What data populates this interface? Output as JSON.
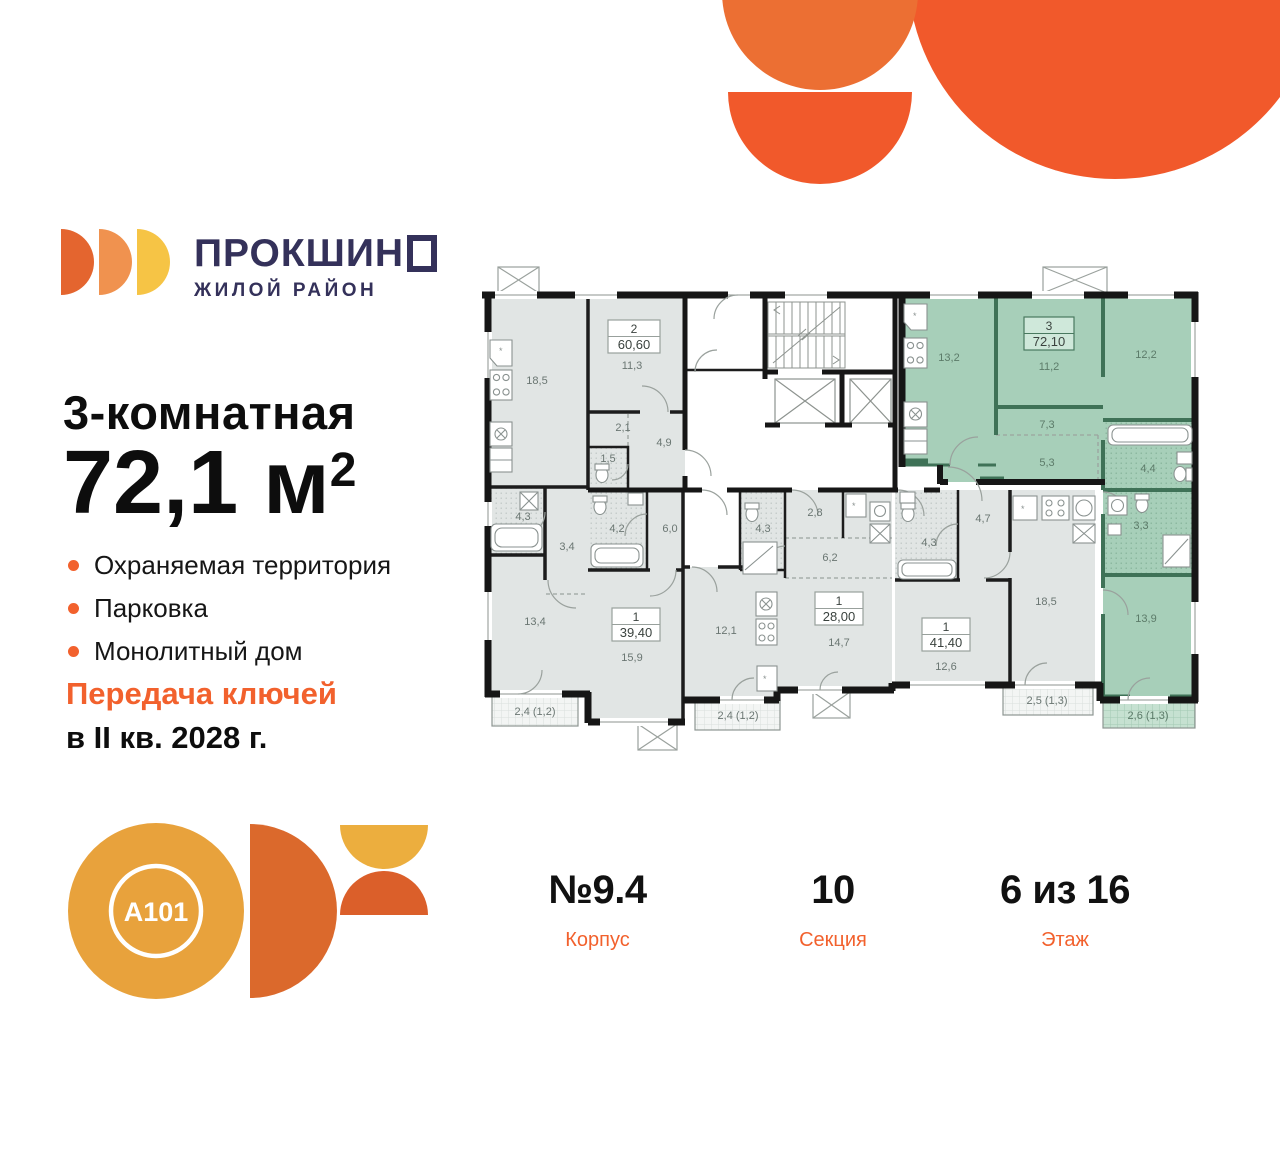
{
  "brand": {
    "name_prefix": "ПРОКШИН",
    "tagline": "ЖИЛОЙ РАЙОН"
  },
  "listing": {
    "headline": "3-комнатная",
    "area_value": "72,1",
    "area_unit": " м",
    "area_exponent": "2",
    "features": [
      "Охраняемая территория",
      "Парковка",
      "Монолитный дом"
    ],
    "handover_line1": "Передача ключей",
    "handover_line2": "в II кв. 2028 г."
  },
  "developer": {
    "logo_text": "A101"
  },
  "stats": [
    {
      "value": "№9.4",
      "label": "Корпус"
    },
    {
      "value": "10",
      "label": "Секция"
    },
    {
      "value": "6 из 16",
      "label": "Этаж"
    }
  ],
  "floorplan": {
    "apartments": [
      {
        "id": "2-room",
        "type_label": "2",
        "area_label": "60,60",
        "rooms": [
          "18,5",
          "11,3",
          "2,1",
          "4,9",
          "1,5",
          "4,3",
          "3,4",
          "13,4"
        ],
        "balcony": "2,4 (1,2)"
      },
      {
        "id": "1-room-a",
        "type_label": "1",
        "area_label": "39,40",
        "rooms": [
          "4,2",
          "6,0",
          "15,9",
          "12,1"
        ],
        "balcony": "2,4 (1,2)"
      },
      {
        "id": "1-room-b",
        "type_label": "1",
        "area_label": "28,00",
        "rooms": [
          "2,8",
          "4,3",
          "6,2",
          "14,7"
        ]
      },
      {
        "id": "1-room-c",
        "type_label": "1",
        "area_label": "41,40",
        "rooms": [
          "4,3",
          "4,7",
          "12,6",
          "18,5"
        ],
        "balcony": "2,5 (1,3)"
      },
      {
        "id": "3-room-highlighted",
        "type_label": "3",
        "area_label": "72,10",
        "rooms": [
          "13,2",
          "11,2",
          "12,2",
          "7,3",
          "5,3",
          "4,4",
          "3,3",
          "13,9"
        ],
        "balcony": "2,6 (1,3)"
      }
    ]
  },
  "colors": {
    "accent": "#F2612D",
    "highlight_green": "#A7CFB9",
    "brand_navy": "#34315A",
    "shape_orange": "#F1592B"
  }
}
